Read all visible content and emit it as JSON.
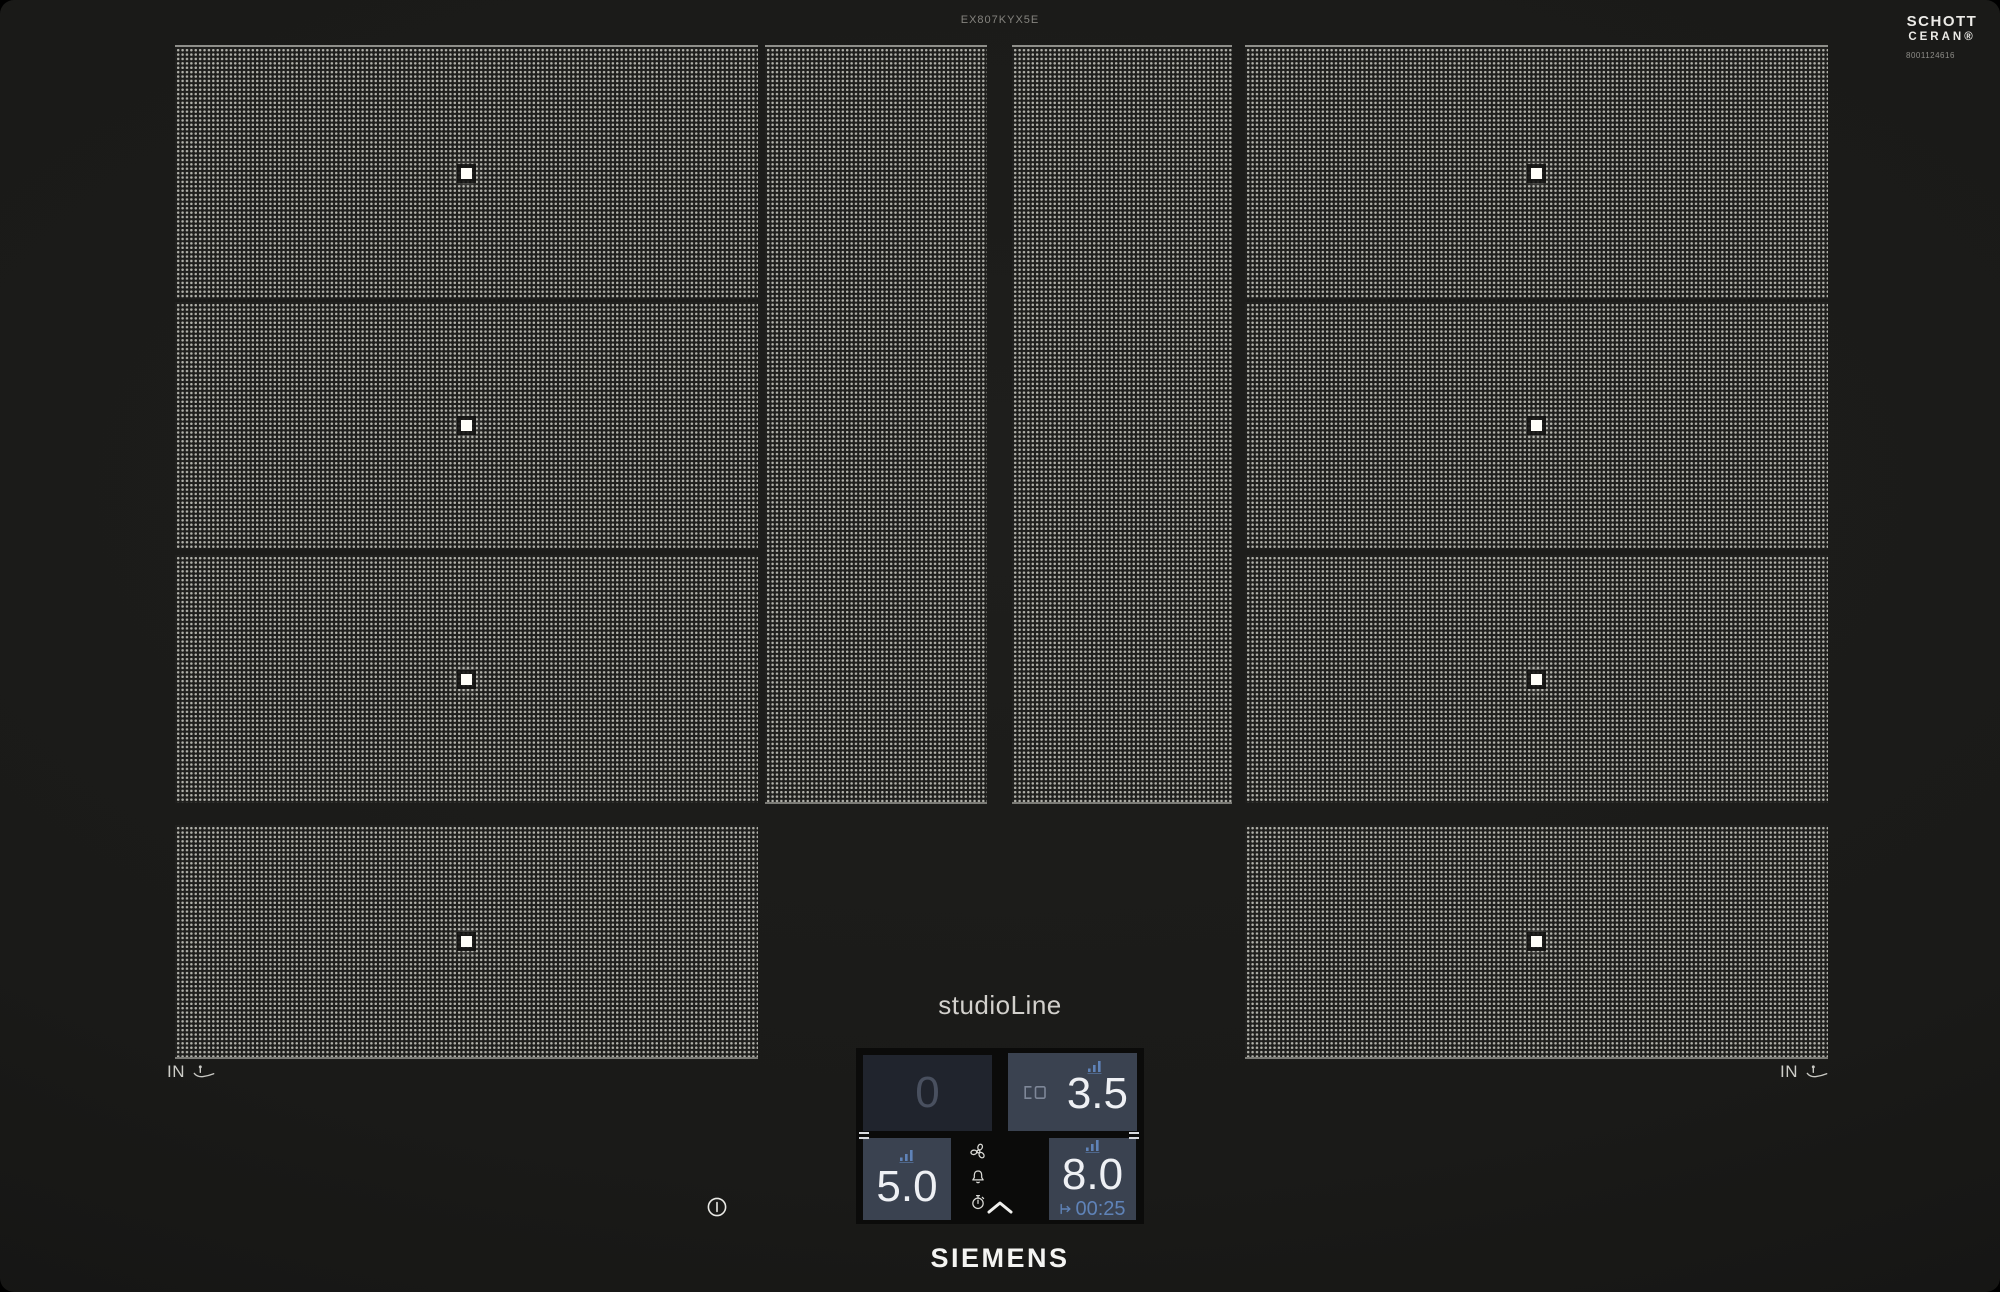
{
  "header": {
    "model_number": "EX807KYX5E"
  },
  "glass_branding": {
    "line1": "SCHOTT",
    "line2": "CERAN®",
    "code": "8001124616"
  },
  "branding": {
    "logo": "SIEMENS",
    "product_line": "studioLine"
  },
  "induction_markers": {
    "left_label": "IN",
    "right_label": "IN"
  },
  "control_panel": {
    "rear_left": {
      "level": "0",
      "state": "standby"
    },
    "rear_right": {
      "level": "3.5",
      "state": "active",
      "icons": [
        "power-level-bars-icon",
        "bridge-zone-icon"
      ]
    },
    "front_left": {
      "level": "5.0",
      "state": "active",
      "icons": [
        "power-level-bars-icon"
      ]
    },
    "front_right": {
      "level": "8.0",
      "state": "active",
      "timer": "00:25",
      "icons": [
        "power-level-bars-icon",
        "timer-end-arrow-icon"
      ]
    },
    "function_icons": [
      "fan-icon",
      "bell-icon",
      "stopwatch-icon"
    ],
    "expand_icon": "chevron-up-icon",
    "power_icon": "power-icon",
    "pan_icon": "pan-detection-icon"
  },
  "colors": {
    "accent_blue": "#5f83b8",
    "panel_active": "#3a4250",
    "panel_standby": "#20242d",
    "surface_black": "#1a1a18",
    "zone_dots": "#b0b0a9"
  }
}
